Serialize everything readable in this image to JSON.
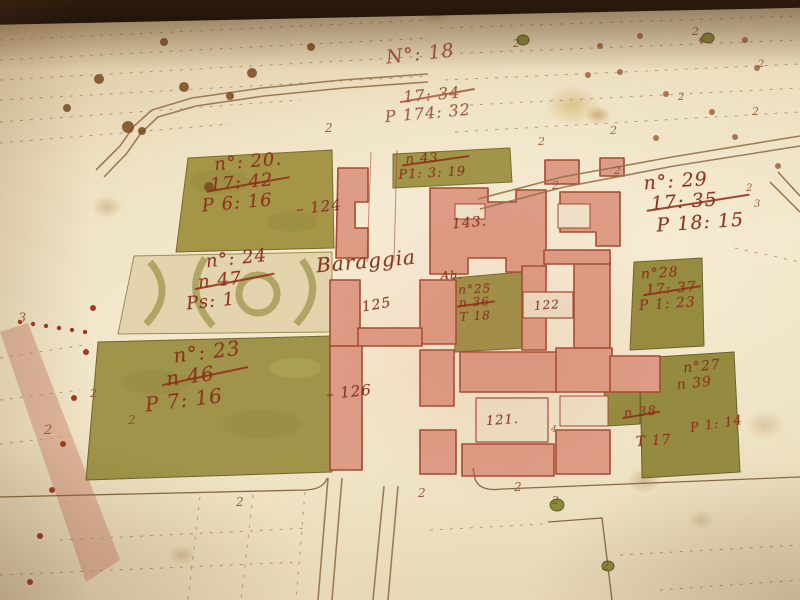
{
  "place_label": "Baraggia",
  "palette": {
    "paper": "#ecdfc0",
    "ink": "#8c3420",
    "olive_parcel": "#9f9449",
    "olive_dark": "#6f682c",
    "building_pink": "#dd9c85",
    "building_outline": "#a34a30",
    "road_line": "#95714b",
    "photo_edge_black": "#0a0705",
    "stain_yellow": "#be8c28"
  },
  "annotations": [
    {
      "id": "plot-18",
      "x": 386,
      "y": 44,
      "rot": -6,
      "size": 19,
      "faded": true,
      "lines": [
        {
          "t": "N°: 18"
        }
      ]
    },
    {
      "id": "plot-18-prior",
      "x": 396,
      "y": 86,
      "rot": -5,
      "size": 16,
      "faded": true,
      "lines": [
        {
          "t": "17: 34",
          "struck": true,
          "dx": 8
        },
        {
          "t": "P 174: 32",
          "dx": -12
        }
      ]
    },
    {
      "id": "parcel-20",
      "x": 200,
      "y": 153,
      "rot": -5,
      "size": 18,
      "lines": [
        {
          "t": "n°: 20.",
          "dx": 16
        },
        {
          "t": "17: 42",
          "struck": true,
          "dx": 10
        },
        {
          "t": "P 6: 16"
        }
      ]
    },
    {
      "id": "ref-124",
      "x": 296,
      "y": 199,
      "rot": -6,
      "size": 15,
      "lines": [
        {
          "t": "– 124"
        }
      ]
    },
    {
      "id": "parcel-43",
      "x": 398,
      "y": 152,
      "rot": -3,
      "size": 13,
      "lines": [
        {
          "t": "n 43",
          "struck": true,
          "dx": 8
        },
        {
          "t": "P1: 3: 19"
        }
      ]
    },
    {
      "id": "ref-143",
      "x": 452,
      "y": 216,
      "rot": -5,
      "size": 14,
      "lines": [
        {
          "t": "143."
        }
      ]
    },
    {
      "id": "parcel-24",
      "x": 188,
      "y": 250,
      "rot": -6,
      "size": 18,
      "lines": [
        {
          "t": "n°: 24",
          "dx": 20
        },
        {
          "t": "n 47",
          "struck": true,
          "dx": 10
        },
        {
          "t": "Ps: 1",
          "dx": -4
        }
      ]
    },
    {
      "id": "parcel-29",
      "x": 645,
      "y": 170,
      "rot": -4,
      "size": 19,
      "lines": [
        {
          "t": "n°: 29"
        },
        {
          "t": "17: 35",
          "struck": true,
          "dx": 6
        },
        {
          "t": "P 18: 15",
          "dx": 10
        }
      ]
    },
    {
      "id": "ref-125",
      "x": 362,
      "y": 298,
      "rot": -10,
      "size": 14,
      "lines": [
        {
          "t": "125"
        }
      ]
    },
    {
      "id": "ref-ab",
      "x": 441,
      "y": 270,
      "rot": 0,
      "size": 11,
      "lines": [
        {
          "t": "Ab."
        }
      ]
    },
    {
      "id": "parcel-25",
      "x": 459,
      "y": 283,
      "rot": -3,
      "size": 12,
      "lines": [
        {
          "t": "n°25"
        },
        {
          "t": "n 36",
          "struck": true
        },
        {
          "t": "T 18"
        }
      ]
    },
    {
      "id": "ref-122",
      "x": 534,
      "y": 299,
      "rot": -4,
      "size": 12,
      "lines": [
        {
          "t": "122"
        }
      ]
    },
    {
      "id": "parcel-28",
      "x": 638,
      "y": 266,
      "rot": -4,
      "size": 14,
      "lines": [
        {
          "t": "n°28",
          "dx": 4
        },
        {
          "t": "17: 37",
          "struck": true,
          "dx": 8
        },
        {
          "t": "P 1: 23"
        }
      ]
    },
    {
      "id": "parcel-23",
      "x": 152,
      "y": 342,
      "rot": -7,
      "size": 20,
      "lines": [
        {
          "t": "n°: 23",
          "dx": 24
        },
        {
          "t": "n 46",
          "struck": true,
          "dx": 14
        },
        {
          "t": "P 7: 16",
          "dx": -10
        }
      ]
    },
    {
      "id": "ref-126",
      "x": 326,
      "y": 384,
      "rot": -6,
      "size": 15,
      "lines": [
        {
          "t": "– 126"
        }
      ]
    },
    {
      "id": "ref-121",
      "x": 486,
      "y": 414,
      "rot": -4,
      "size": 13,
      "lines": [
        {
          "t": "121."
        }
      ]
    },
    {
      "id": "parcel-27",
      "x": 676,
      "y": 360,
      "rot": -6,
      "size": 14,
      "lines": [
        {
          "t": "n°27",
          "dx": 8
        },
        {
          "t": "n 39"
        }
      ]
    },
    {
      "id": "parcel-27-prior",
      "x": 624,
      "y": 406,
      "rot": -5,
      "size": 13,
      "lines": [
        {
          "t": "n 38",
          "struck": true
        }
      ]
    },
    {
      "id": "parcel-27-area",
      "x": 690,
      "y": 418,
      "rot": -9,
      "size": 13,
      "lines": [
        {
          "t": "P 1: 14"
        }
      ]
    },
    {
      "id": "parcel-30-area",
      "x": 636,
      "y": 434,
      "rot": -4,
      "size": 14,
      "lines": [
        {
          "t": "T 17"
        }
      ]
    }
  ],
  "marks": [
    {
      "x": 325,
      "y": 122,
      "g": "2",
      "s": 12
    },
    {
      "x": 538,
      "y": 136,
      "g": "2",
      "s": 11
    },
    {
      "x": 610,
      "y": 125,
      "g": "2",
      "s": 11
    },
    {
      "x": 552,
      "y": 180,
      "g": "2",
      "s": 11
    },
    {
      "x": 614,
      "y": 165,
      "g": "2",
      "s": 11
    },
    {
      "x": 692,
      "y": 26,
      "g": "2",
      "s": 11
    },
    {
      "x": 513,
      "y": 38,
      "g": "2",
      "s": 11
    },
    {
      "x": 752,
      "y": 106,
      "g": "2",
      "s": 11
    },
    {
      "x": 746,
      "y": 184,
      "g": "2",
      "s": 10
    },
    {
      "x": 754,
      "y": 200,
      "g": "3",
      "s": 10
    },
    {
      "x": 678,
      "y": 93,
      "g": "2",
      "s": 10
    },
    {
      "x": 758,
      "y": 60,
      "g": "2",
      "s": 10
    },
    {
      "x": 18,
      "y": 312,
      "g": "3",
      "s": 13
    },
    {
      "x": 44,
      "y": 424,
      "g": "2",
      "s": 13
    },
    {
      "x": 128,
      "y": 414,
      "g": "2",
      "s": 12
    },
    {
      "x": 90,
      "y": 388,
      "g": "2",
      "s": 11
    },
    {
      "x": 236,
      "y": 496,
      "g": "2",
      "s": 12
    },
    {
      "x": 418,
      "y": 487,
      "g": "2",
      "s": 12
    },
    {
      "x": 514,
      "y": 481,
      "g": "2",
      "s": 12
    },
    {
      "x": 552,
      "y": 495,
      "g": "2",
      "s": 11
    },
    {
      "x": 602,
      "y": 560,
      "g": "2",
      "s": 12
    },
    {
      "x": 551,
      "y": 426,
      "g": "4",
      "s": 9
    }
  ]
}
